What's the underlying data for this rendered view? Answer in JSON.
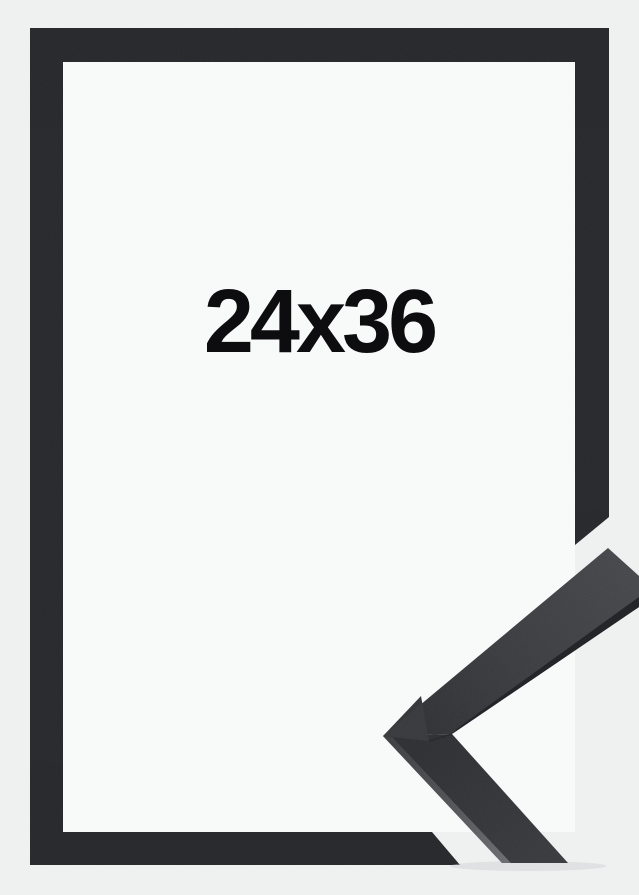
{
  "product_photo": {
    "size_label": "24x36",
    "subject": "black picture frame with corner moulding detail"
  },
  "colors": {
    "background": "#eff0f0",
    "frame_black": "#27282b",
    "mat_white": "#f8f9f9",
    "label_text": "#0d0d0f",
    "moulding_face_light": "#47484c",
    "moulding_face_dark": "#2c2d31",
    "moulding_edge_dark": "#1f2024",
    "moulding_edge_light": "#63656a",
    "moulding_corner_facet": "#37383c"
  }
}
